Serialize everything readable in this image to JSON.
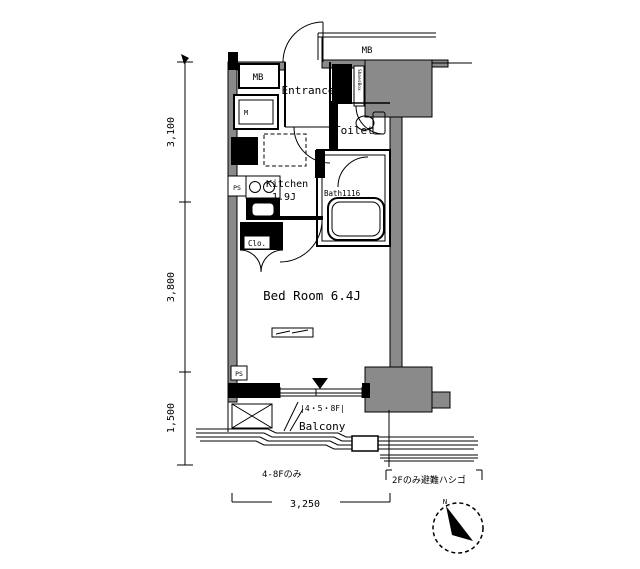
{
  "rooms": {
    "entrance": "Entrance",
    "toilet": "Toilet",
    "kitchen": "Kitchen",
    "kitchen_size": "1.9J",
    "bath": "Bath1116",
    "bedroom": "Bed Room 6.4J",
    "balcony": "Balcony",
    "balcony_floors": "|4・5・8F|",
    "closet": "Clo.",
    "shoes_box": "ShoesBox"
  },
  "labels": {
    "mb_top": "MB",
    "mb_left": "MB",
    "meter": "M",
    "ps_upper": "PS",
    "ps_lower": "PS",
    "floors_note": "4-8Fのみ",
    "ladder_note": "2Fのみ避難ハシゴ",
    "north_mark": "N"
  },
  "dimensions": {
    "left_top": "3,100",
    "left_middle": "3,800",
    "left_bottom": "1,500",
    "bottom": "3,250"
  },
  "colors": {
    "line": "#000000",
    "concrete": "#8a8a8a",
    "background": "#ffffff"
  }
}
